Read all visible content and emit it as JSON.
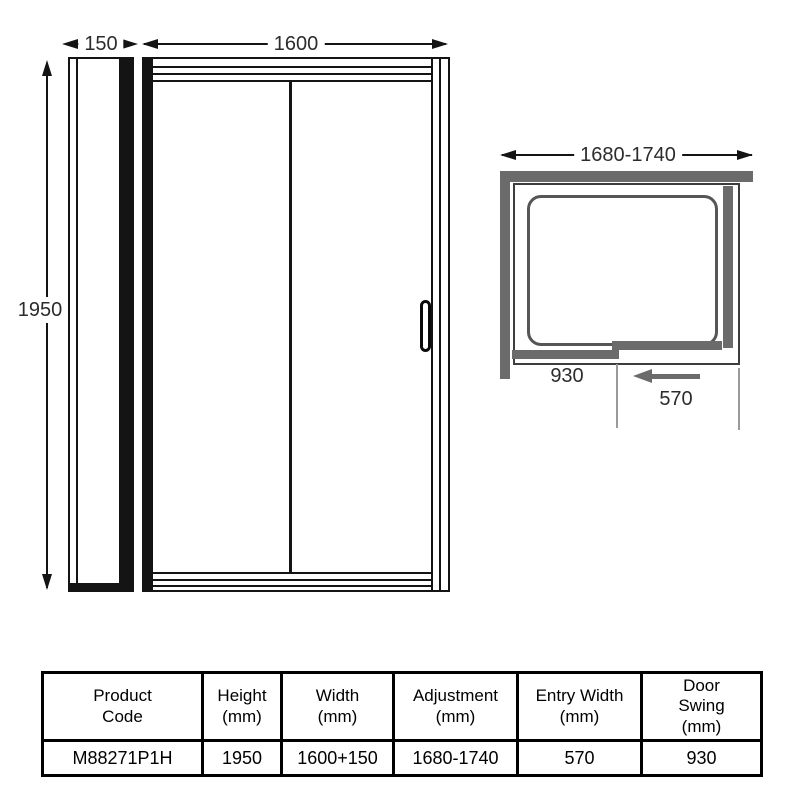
{
  "front_view": {
    "panel_width_label": "150",
    "door_width_label": "1600",
    "height_label": "1950"
  },
  "plan_view": {
    "adjustment_label": "1680-1740",
    "door_swing_label": "930",
    "entry_width_label": "570"
  },
  "spec_table": {
    "headers": [
      {
        "l1": "Product",
        "l2": "Code"
      },
      {
        "l1": "Height",
        "l2": "(mm)"
      },
      {
        "l1": "Width",
        "l2": "(mm)"
      },
      {
        "l1": "Adjustment",
        "l2": "(mm)"
      },
      {
        "l1": "Entry Width",
        "l2": "(mm)"
      },
      {
        "l1": "Door",
        "l2": "Swing",
        "l3": "(mm)"
      }
    ],
    "row": [
      "M88271P1H",
      "1950",
      "1600+150",
      "1680-1740",
      "570",
      "930"
    ]
  },
  "colors": {
    "line": "#141414",
    "wall_gray": "#6b6b6b",
    "tray_border": "#565656"
  }
}
